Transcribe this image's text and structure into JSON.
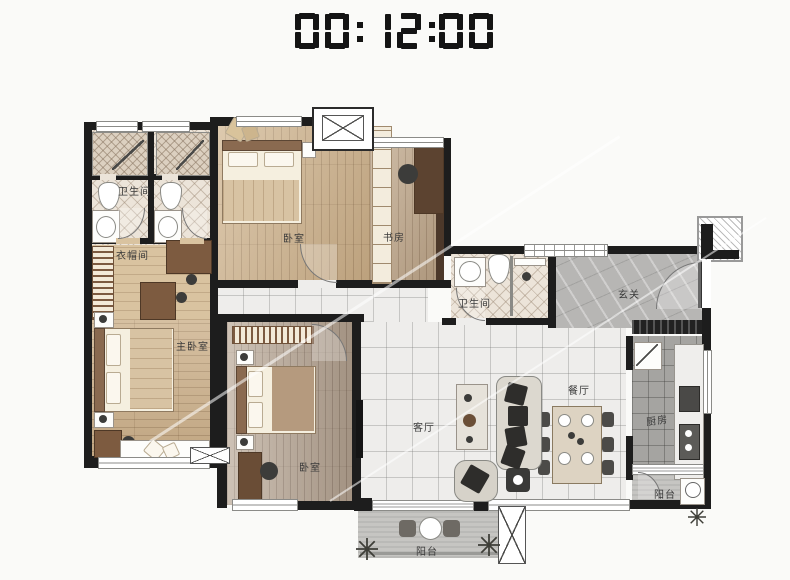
{
  "clock": {
    "time": "00:12:00"
  },
  "rooms": {
    "bath1": {
      "label": "卫生间"
    },
    "bath2": {
      "label": "卫生间"
    },
    "cloak": {
      "label": "衣帽间"
    },
    "master": {
      "label": "主卧室"
    },
    "bed2": {
      "label": "卧室"
    },
    "bed3": {
      "label": "卧室"
    },
    "study": {
      "label": "书房"
    },
    "foyer": {
      "label": "玄关"
    },
    "living": {
      "label": "客厅"
    },
    "dining": {
      "label": "餐厅"
    },
    "kitchen": {
      "label": "厨房"
    },
    "balcony_right": {
      "label": "阳台"
    },
    "balcony_bottom": {
      "label": "阳台"
    }
  },
  "colors": {
    "wall": "#1d1d1d",
    "clock_segment": "#141414"
  }
}
